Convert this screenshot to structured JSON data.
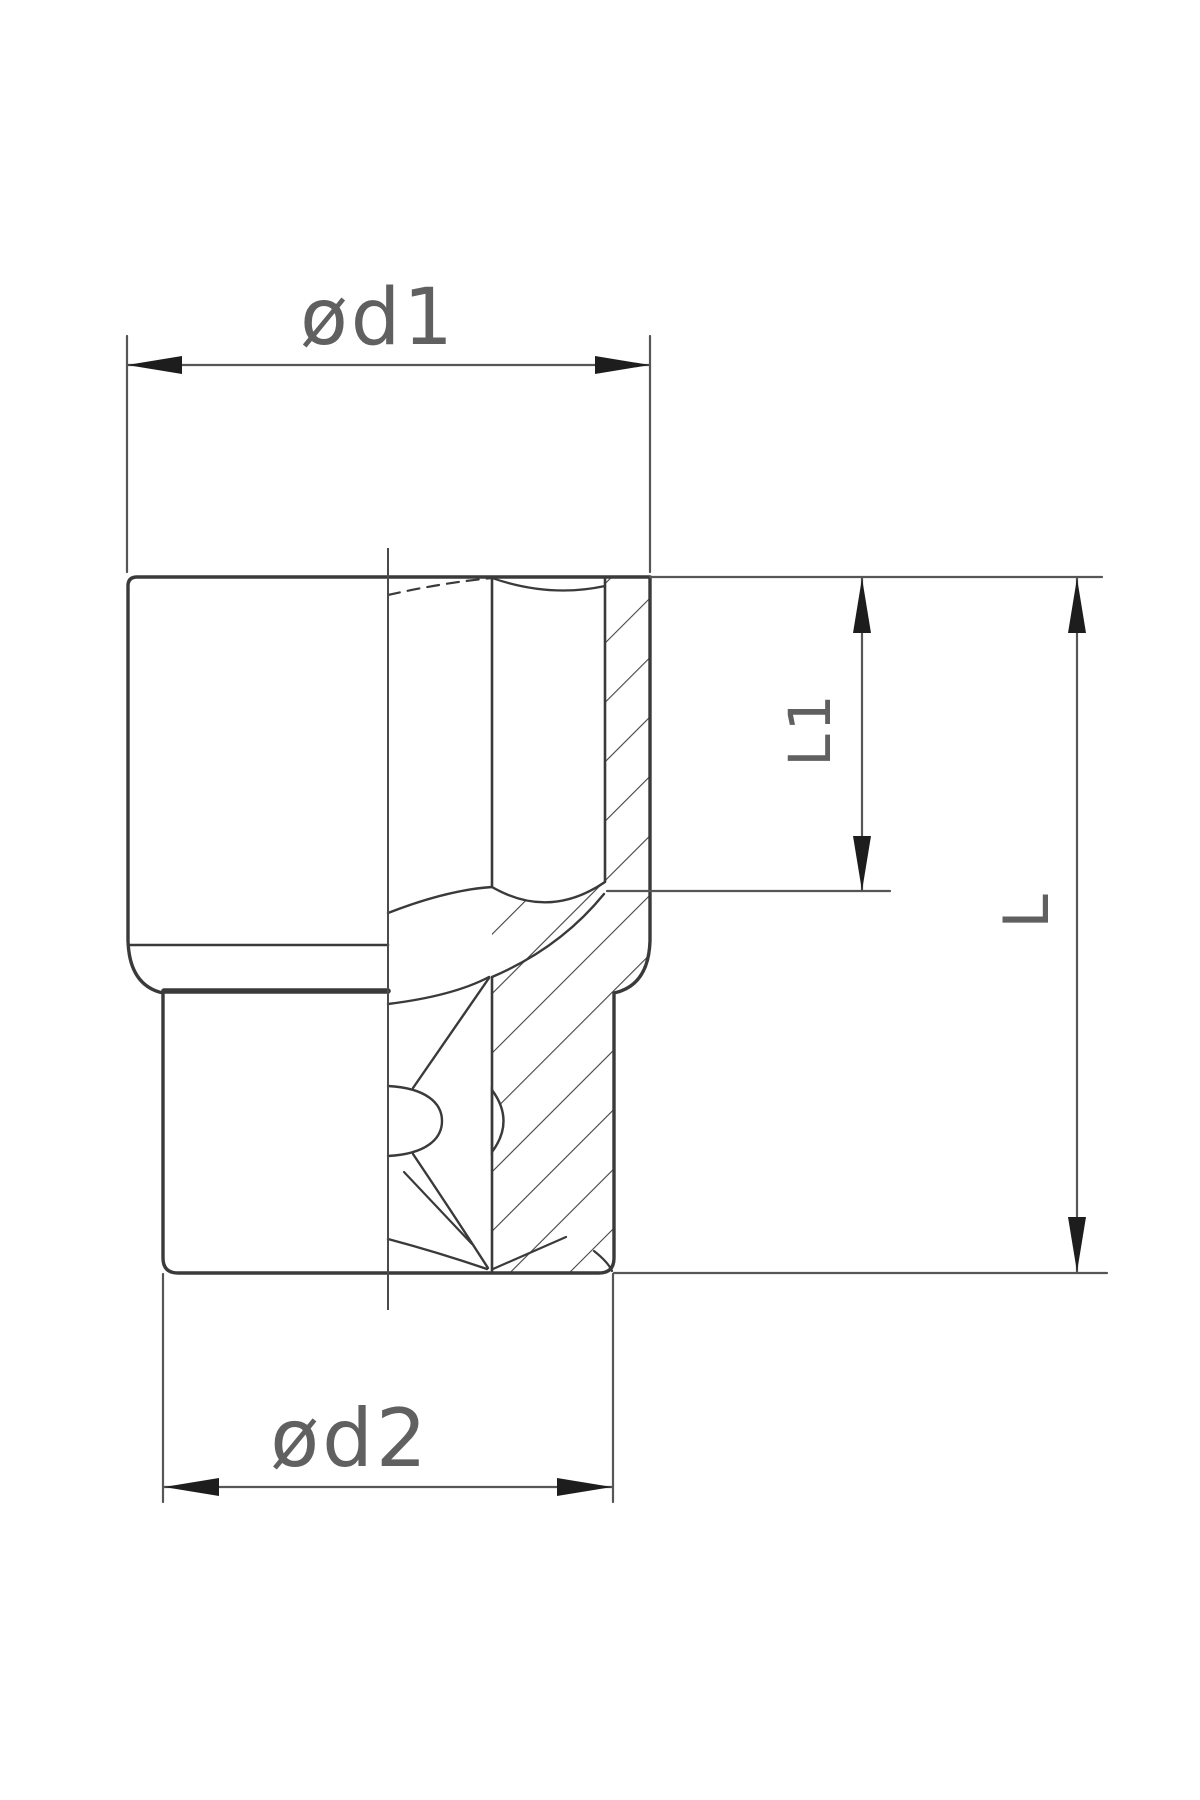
{
  "drawing": {
    "background": "#ffffff",
    "colors": {
      "outline": "#3a3a3a",
      "centerline": "#4a4a4a",
      "dimension_line": "#565656",
      "arrow": "#1d1d1d",
      "label_text": "#606060",
      "hatch": "#424242"
    },
    "dimensions": {
      "top_diameter": {
        "label": "ød1"
      },
      "bottom_diameter": {
        "label": "ød2"
      },
      "bore_depth": {
        "label": "L1"
      },
      "overall_length": {
        "label": "L"
      }
    }
  }
}
